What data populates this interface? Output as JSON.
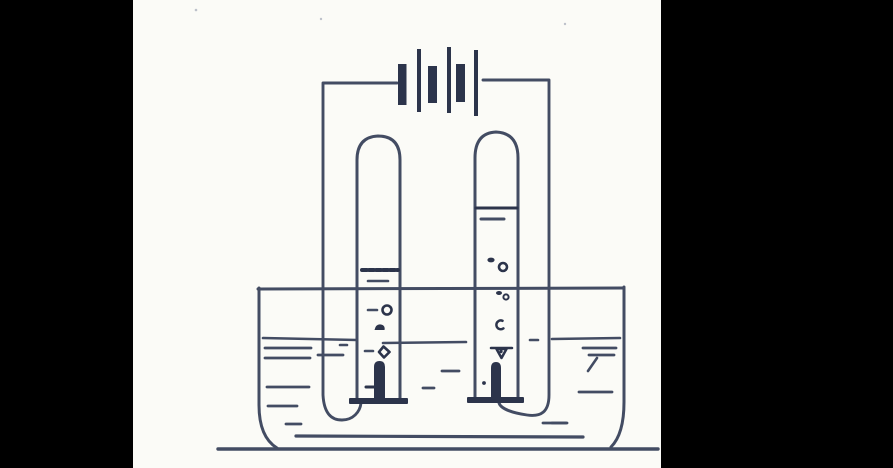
{
  "colors": {
    "background": "#000000",
    "paper": "#fbfbf7",
    "ink": "#434c63",
    "ink_dark": "#2c344b",
    "ink_light": "#8b92a6"
  },
  "diagram": {
    "kind": "hand-drawn line sketch of a water electrolysis apparatus",
    "components": [
      "battery-of-three-cells",
      "connecting-wire-left",
      "connecting-wire-right",
      "inverted-gas-tube-left",
      "inverted-gas-tube-right",
      "gas-level-line-left",
      "gas-level-line-right",
      "electrode-left-on-stand",
      "electrode-right-on-stand",
      "gas-bubbles",
      "water-trough",
      "water-surface-line",
      "water-shading-dashes",
      "ground-line"
    ],
    "observations": {
      "battery_plates": "three thick short plates alternating with three thin tall plates",
      "gas_volume_ratio_left_to_right": "approximately 2:1",
      "bubbles_rising": "both tubes show small bubbles above each electrode"
    }
  }
}
